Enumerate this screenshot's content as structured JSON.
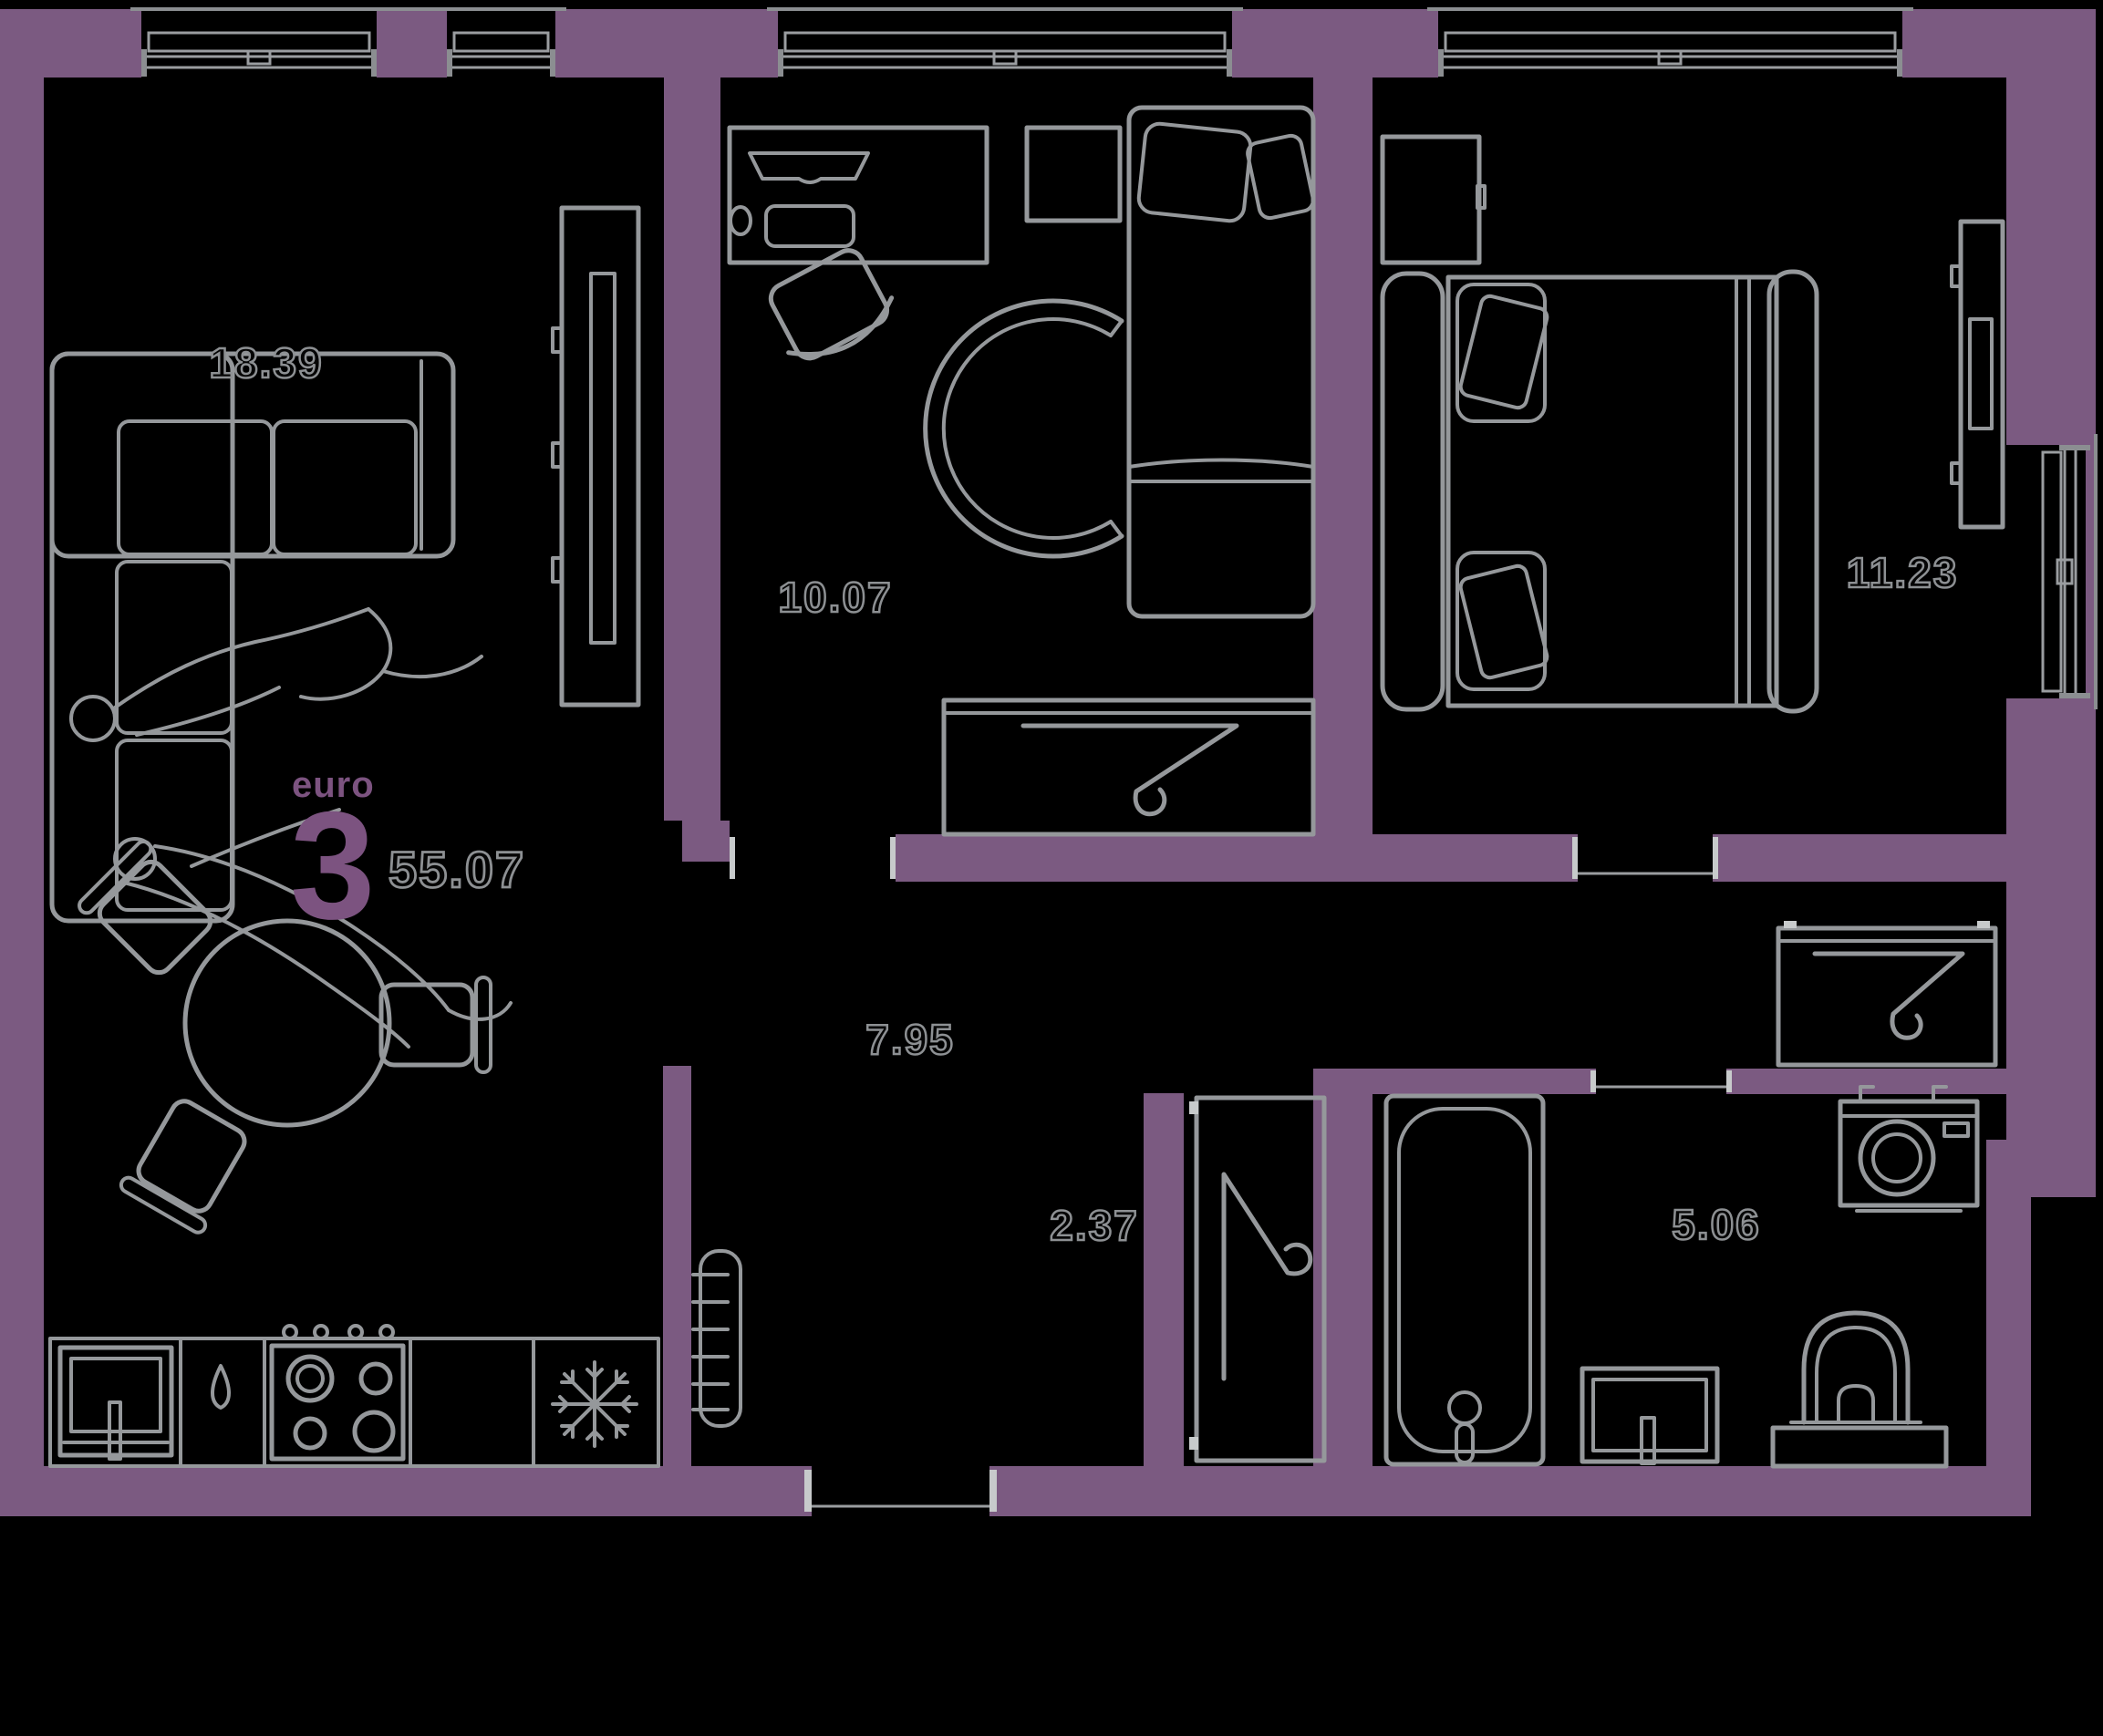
{
  "plan_badge": {
    "format_label": "euro",
    "format_number": "3",
    "total_area": "55.07"
  },
  "rooms": [
    {
      "name": "living-kitchen",
      "area": "18.39"
    },
    {
      "name": "bedroom-children",
      "area": "10.07"
    },
    {
      "name": "bedroom-master",
      "area": "11.23"
    },
    {
      "name": "hallway",
      "area": "7.95"
    },
    {
      "name": "closet",
      "area": "2.37"
    },
    {
      "name": "bathroom",
      "area": "5.06"
    }
  ],
  "colors": {
    "background": "#000000",
    "wall": "#7B5A81",
    "furniture_line": "#95989B",
    "label_outline": "#8D9093",
    "accent_purple": "#7C5380"
  },
  "furniture_symbols": [
    "corner-sofa",
    "couple-lying",
    "tv-panel",
    "round-dining-table",
    "chair",
    "kitchen-counter",
    "kitchen-sink",
    "faucet-drop",
    "hob-4-burners",
    "fridge-snowflake",
    "towel-radiator",
    "desk",
    "monitor",
    "keyboard",
    "mouse",
    "office-chair",
    "nightstand",
    "single-bed",
    "round-cradle",
    "wardrobe-hanger",
    "double-bed",
    "bathtub",
    "washing-machine",
    "toilet",
    "bathroom-sink",
    "cabinet",
    "window"
  ]
}
